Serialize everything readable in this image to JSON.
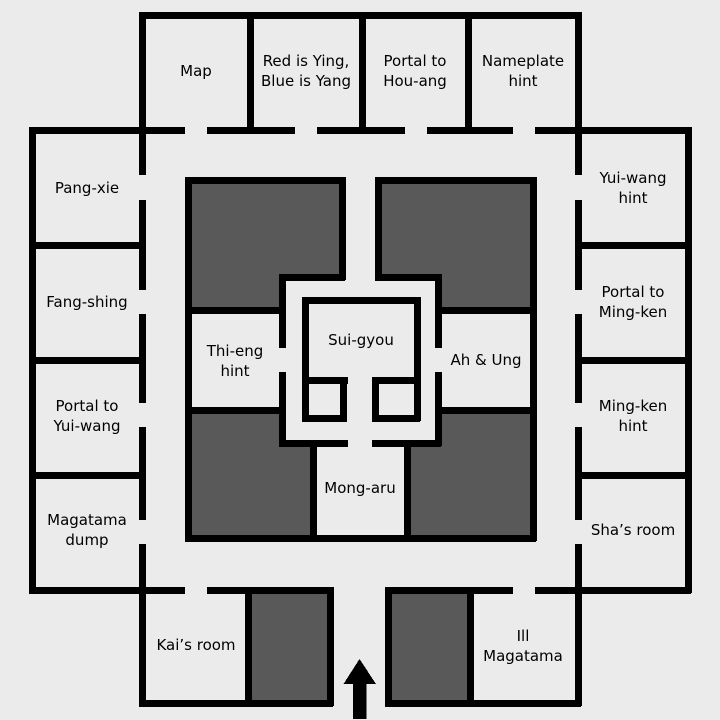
{
  "colors": {
    "background": "#ebebeb",
    "wall": "#000000",
    "dark_room_fill": "#595959",
    "label_text": "#000000"
  },
  "rooms": {
    "map": {
      "label": "Map"
    },
    "red_blue": {
      "label": "Red is Ying,\nBlue is Yang"
    },
    "portal_houang": {
      "label": "Portal to\nHou-ang"
    },
    "nameplate_hint": {
      "label": "Nameplate\nhint"
    },
    "pang_xie": {
      "label": "Pang-xie"
    },
    "fang_shing": {
      "label": "Fang-shing"
    },
    "portal_yuiwang": {
      "label": "Portal to\nYui-wang"
    },
    "magatama_dump": {
      "label": "Magatama\ndump"
    },
    "yuiwang_hint": {
      "label": "Yui-wang\nhint"
    },
    "portal_mingken": {
      "label": "Portal to\nMing-ken"
    },
    "mingken_hint": {
      "label": "Ming-ken\nhint"
    },
    "shas_room": {
      "label": "Sha’s room"
    },
    "kais_room": {
      "label": "Kai’s room"
    },
    "ill_magatama": {
      "label": "Ill\nMagatama"
    },
    "thi_eng_hint": {
      "label": "Thi-eng\nhint"
    },
    "ah_ung": {
      "label": "Ah & Ung"
    },
    "sui_gyou": {
      "label": "Sui-gyou"
    },
    "mong_aru": {
      "label": "Mong-aru"
    }
  },
  "entrance": {
    "icon": "up-arrow"
  }
}
